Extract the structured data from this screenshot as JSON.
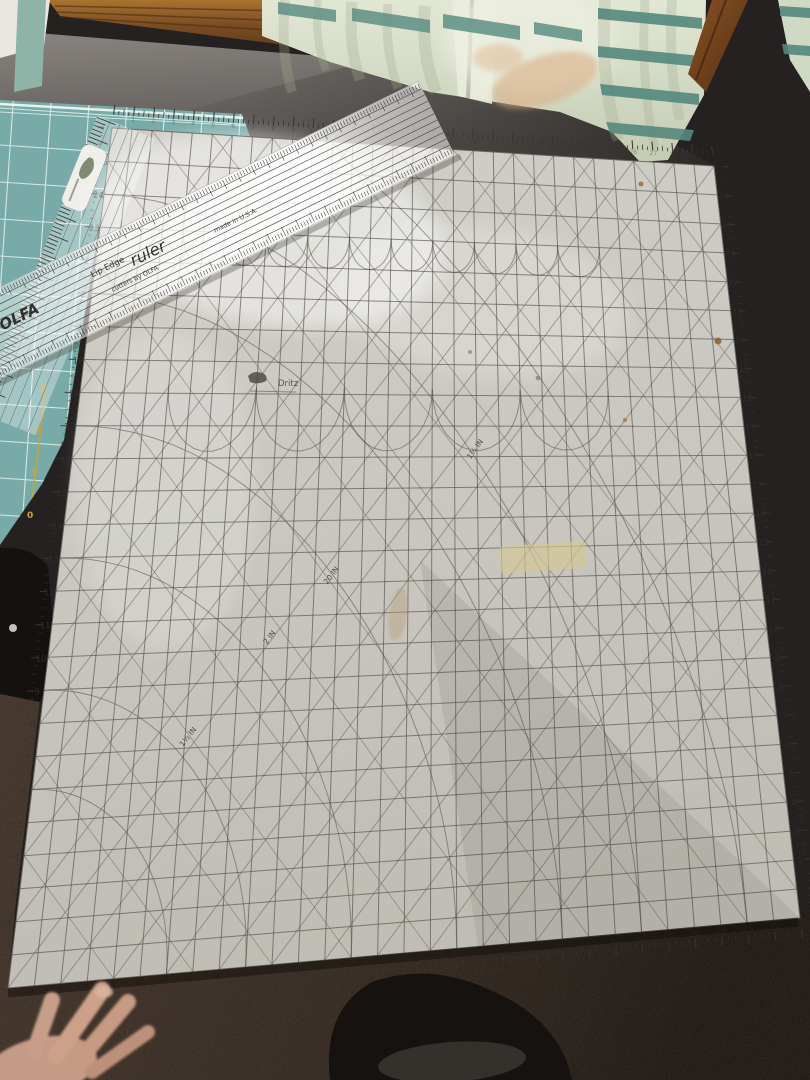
{
  "large_mat": {
    "brand": "Dritz",
    "bottom_scale": [
      "1",
      "2",
      "3",
      "4",
      "5",
      "6",
      "7",
      "8",
      "9",
      "10",
      "11",
      "12",
      "13",
      "14",
      "15",
      "16",
      "17",
      "18",
      "19",
      "20",
      "21",
      "22",
      "23",
      "24",
      "25",
      "26",
      "27",
      "28",
      "29"
    ],
    "left_scale": [
      "2",
      "3",
      "4",
      "5",
      "6",
      "7",
      "8",
      "9",
      "10",
      "11",
      "12",
      "13",
      "14",
      "15",
      "16",
      "17",
      "18",
      "19",
      "20",
      "21",
      "22",
      "23",
      "24",
      "25"
    ],
    "right_scale": [
      "2",
      "3",
      "4",
      "5",
      "6",
      "7",
      "8",
      "9",
      "10",
      "11",
      "12",
      "13",
      "14",
      "15",
      "16",
      "17",
      "18",
      "19",
      "20",
      "21",
      "22",
      "23",
      "24",
      "25"
    ],
    "top_scale": [
      "1",
      "2",
      "3",
      "4",
      "5",
      "6",
      "7",
      "8",
      "9",
      "10",
      "11",
      "12",
      "13",
      "14",
      "15",
      "16",
      "17",
      "18",
      "19",
      "20",
      "21",
      "22",
      "23",
      "24",
      "25",
      "26",
      "27",
      "28",
      "29"
    ],
    "bias_labels": [
      "1½ IN",
      "2 IN",
      "20 IN",
      "1½ IN"
    ]
  },
  "olfa_ruler": {
    "brand": "OLFA",
    "product_prefix": "Lip Edge",
    "product_suffix": "ruler",
    "tagline": "cutters by OLFA",
    "origin": "made in U.S.A."
  },
  "teal_mat": {
    "scale": [
      "3",
      "2",
      "1",
      "0"
    ]
  },
  "colors": {
    "teal_mat": "#78aaa8",
    "mat_surface": "#c9c7c0",
    "curtain": "#d6ddc9",
    "curtain_stripe": "#5d8e84",
    "carpet": "#32271f",
    "table": "#6e6a68",
    "wood": "#8a5a2e",
    "skin": "#c79e8a"
  }
}
